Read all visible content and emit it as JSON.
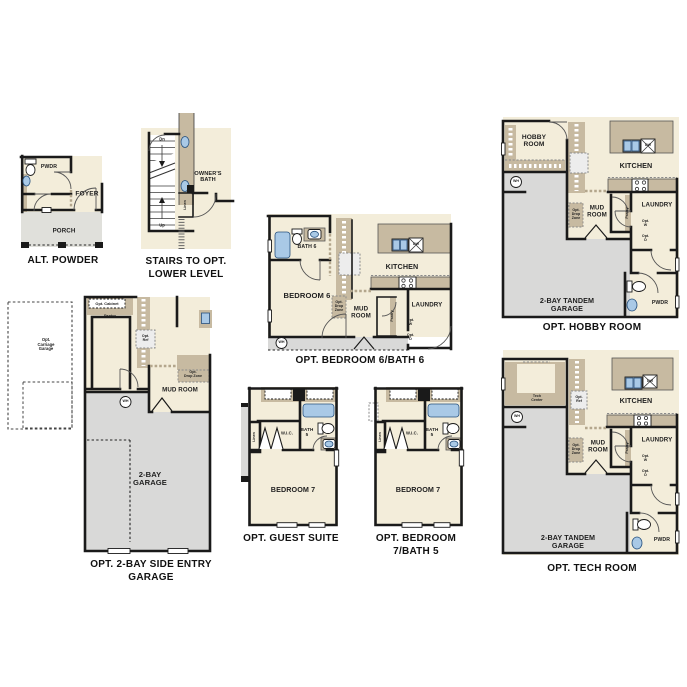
{
  "document": {
    "background": "#ffffff"
  },
  "palette": {
    "floor": "#f3edda",
    "cabinet": "#c7baa1",
    "garage_floor": "#d9d9d8",
    "porch_floor": "#e0e0db",
    "fixture_blue": "#a9c9e6",
    "wall": "#1a1a1a",
    "text": "#1f1f1f"
  },
  "plans": {
    "alt_powder": {
      "caption": "ALT. POWDER",
      "labels": {
        "pwdr": "PWDR",
        "foyer": "FOYER",
        "porch": "PORCH"
      }
    },
    "stairs_lower_level": {
      "caption": "STAIRS TO OPT.\nLOWER LEVEL",
      "labels": {
        "dn": "Dn",
        "up": "Up",
        "linen": "Linen",
        "owners_bath": "OWNER'S\nBATH"
      }
    },
    "bedroom6_bath6": {
      "caption": "OPT. BEDROOM 6/BATH 6",
      "labels": {
        "bath6": "BATH 6",
        "bedroom6": "BEDROOM 6",
        "kitchen": "KITCHEN",
        "mud_room": "MUD\nROOM",
        "laundry": "LAUNDRY",
        "pantry": "Pantry",
        "opt_drop_zone": "Opt.\nDrop\nZone",
        "opt_w": "Opt.\nW",
        "opt_d": "Opt.\nD",
        "wh": "WH",
        "dw": "DW"
      }
    },
    "hobby_room": {
      "caption": "OPT. HOBBY ROOM",
      "labels": {
        "hobby_room": "HOBBY\nROOM",
        "kitchen": "KITCHEN",
        "mud_room": "MUD\nROOM",
        "laundry": "LAUNDRY",
        "pwdr": "PWDR",
        "garage": "2-BAY TANDEM\nGARAGE",
        "pantry": "Pantry",
        "opt_drop_zone": "Opt.\nDrop\nZone",
        "opt_w": "Opt.\nW",
        "opt_d": "Opt.\nD",
        "wh": "WH",
        "dw": "DW"
      }
    },
    "side_entry_garage": {
      "caption": "OPT. 2-BAY SIDE ENTRY GARAGE",
      "labels": {
        "opt_cabinet": "Opt. Cabinet",
        "pantry": "Pantry",
        "opt_ref": "Opt.\nRef",
        "opt_carriage_garage": "Opt.\nCarriage\nGarage",
        "opt_drop_zone": "Opt.\nDrop Zone",
        "mud_room": "MUD ROOM",
        "garage": "2-BAY\nGARAGE",
        "wh": "WH"
      }
    },
    "guest_suite": {
      "caption": "OPT. GUEST SUITE",
      "labels": {
        "bedroom7": "BEDROOM 7",
        "bath5": "BATH\n5",
        "wic": "W.I.C.",
        "linen": "Linen"
      }
    },
    "bedroom7_bath5": {
      "caption": "OPT. BEDROOM 7/BATH 5",
      "labels": {
        "bedroom7": "BEDROOM 7",
        "bath5": "BATH\n5",
        "wic": "W.I.C.",
        "linen": "Linen"
      }
    },
    "tech_room": {
      "caption": "OPT. TECH ROOM",
      "labels": {
        "tech_center": "Tech\nCenter",
        "kitchen": "KITCHEN",
        "mud_room": "MUD\nROOM",
        "laundry": "LAUNDRY",
        "pwdr": "PWDR",
        "garage": "2-BAY TANDEM\nGARAGE",
        "pantry": "Pantry",
        "opt_drop_zone": "Opt.\nDrop\nZone",
        "opt_ref": "Opt.\nRef",
        "opt_w": "Opt.\nW",
        "opt_d": "Opt.\nD",
        "wh": "WH",
        "dw": "DW"
      }
    }
  }
}
